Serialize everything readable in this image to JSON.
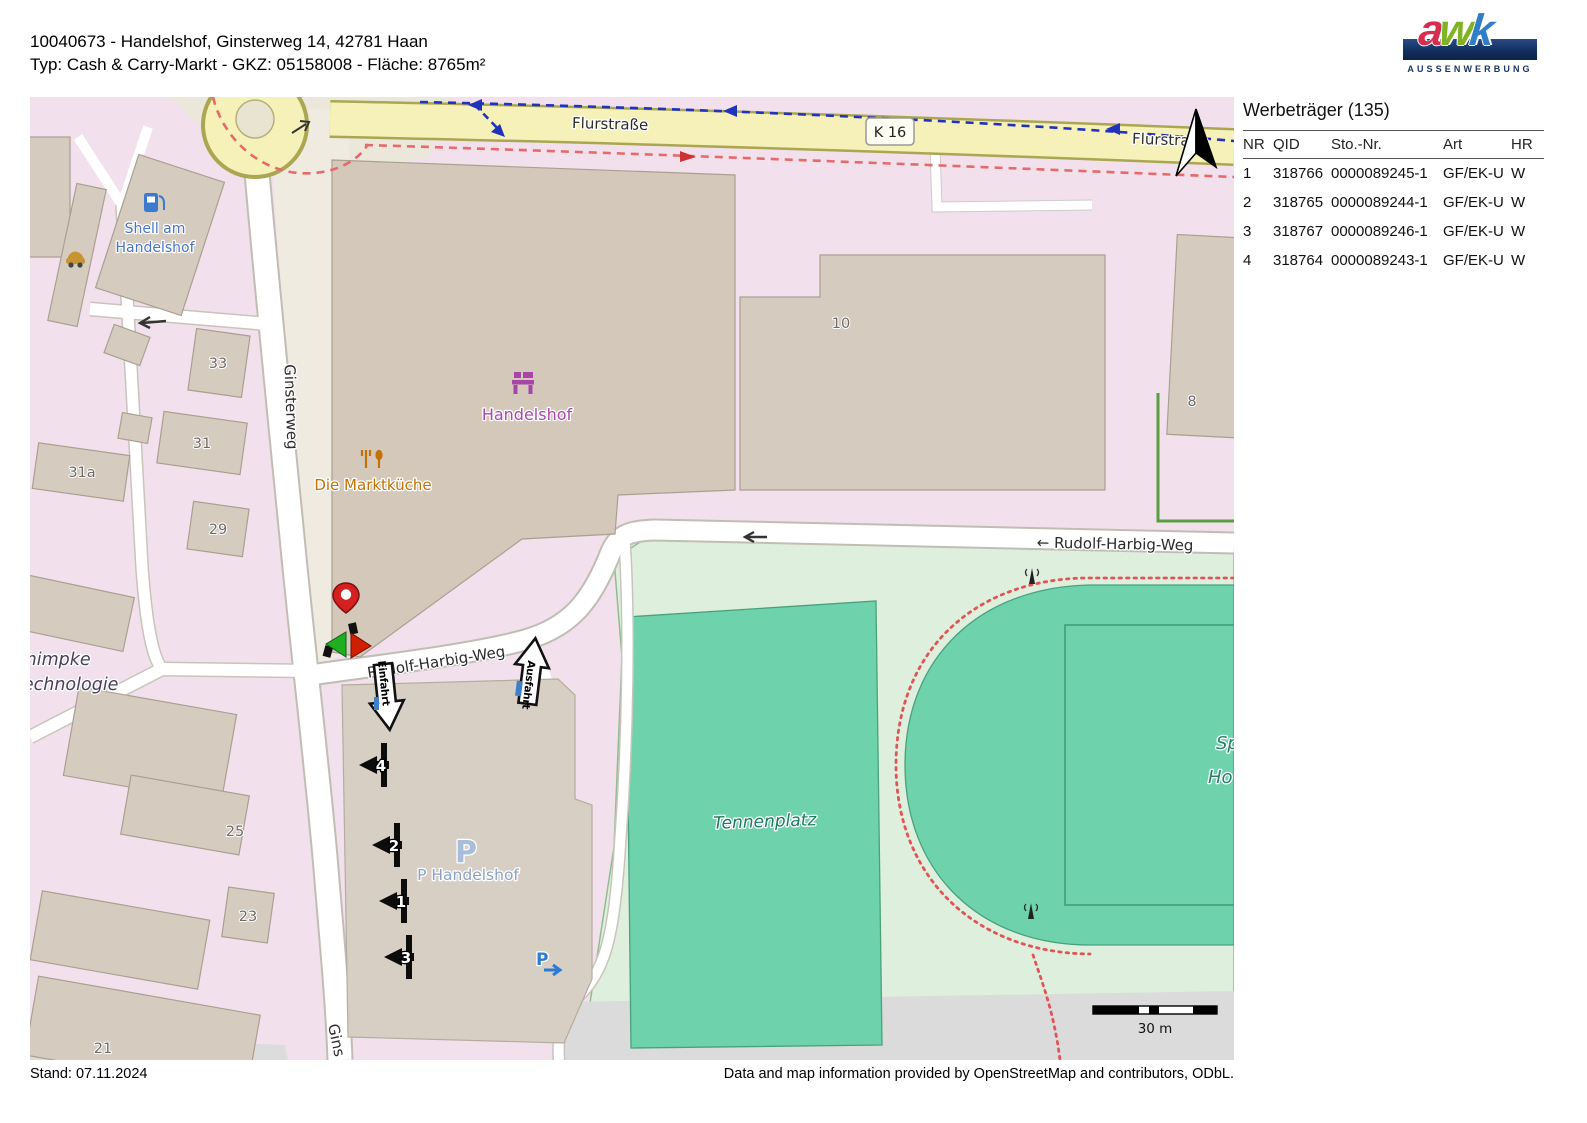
{
  "header": {
    "line1": "10040673 - Handelshof, Ginsterweg 14, 42781 Haan",
    "line2": "Typ: Cash & Carry-Markt - GKZ: 05158008 - Fläche: 8765m²"
  },
  "logo": {
    "letters": [
      "a",
      "w",
      "k"
    ],
    "subtext": "AUSSENWERBUNG",
    "colors": {
      "bar": "#122e5e",
      "a": "#d82e4e",
      "w": "#7fb322",
      "k": "#2f7ec7"
    }
  },
  "panel": {
    "title": "Werbeträger (135)",
    "columns": [
      "NR",
      "QID",
      "Sto.-Nr.",
      "Art",
      "HR"
    ],
    "rows": [
      [
        "1",
        "318766",
        "0000089245-1",
        "GF/EK-U",
        "W"
      ],
      [
        "2",
        "318765",
        "0000089244-1",
        "GF/EK-U",
        "W"
      ],
      [
        "3",
        "318767",
        "0000089246-1",
        "GF/EK-U",
        "W"
      ],
      [
        "4",
        "318764",
        "0000089243-1",
        "GF/EK-U",
        "W"
      ]
    ]
  },
  "map": {
    "streets": {
      "flurstrasse": "Flurstraße",
      "flurstrasse2": "Flurstraße",
      "k16": "K 16",
      "ginsterweg": "Ginsterweg",
      "ginsterweg_bottom": "Gins",
      "rudolf_harbig_weg": "← Rudolf-Harbig-Weg",
      "rudolf_harbig_weg_lower": "Rudolf-Harbig-Weg"
    },
    "places": {
      "shell_line1": "Shell am",
      "shell_line2": "Handelshof",
      "handelshof": "Handelshof",
      "marktkueche": "Die Marktküche",
      "tennenplatz": "Tennenplatz",
      "sportplatz_cut1": "Sp",
      "sportplatz_cut2": "Ho",
      "chimpke_line1": "chimpke",
      "chimpke_line2": "technologie",
      "parking_big_p": "P",
      "parking": "P Handelshof",
      "parking_small_p": "P"
    },
    "house_numbers": [
      "33",
      "31",
      "31a",
      "29",
      "25",
      "23",
      "21",
      "10",
      "8"
    ],
    "wt_markers": [
      "4",
      "2",
      "1",
      "3"
    ],
    "flow_arrows": {
      "einfahrt": "Einfahrt",
      "ausfahrt": "Ausfahrt"
    },
    "scale_label": "30 m",
    "colors": {
      "landuse_pink": "#f2e1ec",
      "building": "#d6cbbf",
      "road_yellow": "#f5f1b8",
      "sports_light": "#def0dd",
      "pitch_teal": "#6ed3ac",
      "route_blue": "#2233bb",
      "boundary_red": "#e05555",
      "marker_red": "#cf1f00",
      "marker_green": "#1fae1f"
    }
  },
  "footer": {
    "stand": "Stand: 07.11.2024",
    "attribution": "Data and map information provided by OpenStreetMap and contributors, ODbL."
  }
}
